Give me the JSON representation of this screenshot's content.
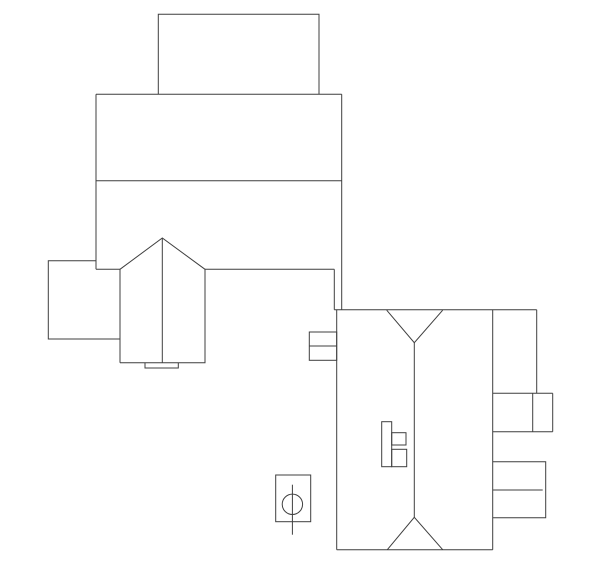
{
  "canvas": {
    "width": 600,
    "height": 569,
    "background_color": "#ffffff",
    "stroke_color": "#3f3f3f",
    "stroke_width": 1
  },
  "drawing": {
    "shapes": [
      {
        "name": "upper-annex-rect-outline",
        "type": "polyline",
        "points": "158.3,94.3 158.3,14.3 319,14.3 319,94.3"
      },
      {
        "name": "main-block-top-edge",
        "type": "line",
        "x1": 96,
        "y1": 94.3,
        "x2": 341.7,
        "y2": 94.3
      },
      {
        "name": "main-block-left-edge",
        "type": "line",
        "x1": 96,
        "y1": 94.3,
        "x2": 96,
        "y2": 269.3
      },
      {
        "name": "main-block-right-edge",
        "type": "line",
        "x1": 341.7,
        "y1": 94.3,
        "x2": 341.7,
        "y2": 309.7
      },
      {
        "name": "main-block-divider",
        "type": "line",
        "x1": 96,
        "y1": 180.7,
        "x2": 341.7,
        "y2": 180.7
      },
      {
        "name": "main-block-bottom-left-segment",
        "type": "line",
        "x1": 96,
        "y1": 269.3,
        "x2": 120,
        "y2": 269.3
      },
      {
        "name": "main-block-bottom-right-segment",
        "type": "line",
        "x1": 205,
        "y1": 269.3,
        "x2": 334.3,
        "y2": 269.3
      },
      {
        "name": "main-block-step-left-edge",
        "type": "line",
        "x1": 334.3,
        "y1": 269.3,
        "x2": 334.3,
        "y2": 309.7
      },
      {
        "name": "left-annex-outline",
        "type": "polyline",
        "points": "96,260.7 48.3,260.7 48.3,339 120,339"
      },
      {
        "name": "gable-wing-outline",
        "type": "polyline",
        "points": "120,362.7 120,269.3 162.3,238 205,269.3 205,362.7 120,362.7"
      },
      {
        "name": "gable-wing-ridge-line",
        "type": "line",
        "x1": 162.3,
        "y1": 238,
        "x2": 162.3,
        "y2": 362.7
      },
      {
        "name": "gable-wing-bottom-tab",
        "type": "polyline",
        "points": "145,362.7 145,368 178.3,368 178.3,362.7"
      },
      {
        "name": "lower-building-top-edge",
        "type": "line",
        "x1": 334.3,
        "y1": 309.7,
        "x2": 536.7,
        "y2": 309.7
      },
      {
        "name": "lower-building-left-edge",
        "type": "line",
        "x1": 336.7,
        "y1": 309.7,
        "x2": 336.7,
        "y2": 549.7
      },
      {
        "name": "lower-building-bottom-edge",
        "type": "line",
        "x1": 336.7,
        "y1": 549.7,
        "x2": 492.7,
        "y2": 549.7
      },
      {
        "name": "lower-building-right-edge",
        "type": "line",
        "x1": 492.7,
        "y1": 309.7,
        "x2": 492.7,
        "y2": 549.7
      },
      {
        "name": "lower-building-top-hip-valley",
        "type": "polyline",
        "points": "386.7,310.2 414.3,342.7 442.7,310.2"
      },
      {
        "name": "lower-building-ridge-line",
        "type": "line",
        "x1": 414.3,
        "y1": 342.7,
        "x2": 414.3,
        "y2": 517.3
      },
      {
        "name": "lower-building-bottom-hip-valley",
        "type": "polyline",
        "points": "387.3,549.7 414.3,517.3 442.7,549.7"
      },
      {
        "name": "left-window-bay-rect",
        "type": "rect",
        "x": 309.3,
        "y": 332,
        "w": 27.4,
        "h": 28.3
      },
      {
        "name": "left-window-bay-divider",
        "type": "line",
        "x1": 309.3,
        "y1": 346,
        "x2": 336.7,
        "y2": 346
      },
      {
        "name": "top-right-wing-right-edge",
        "type": "line",
        "x1": 536.7,
        "y1": 309.7,
        "x2": 536.7,
        "y2": 393.3
      },
      {
        "name": "right-wing-upper-shelf-top",
        "type": "line",
        "x1": 492.7,
        "y1": 393.3,
        "x2": 552.7,
        "y2": 393.3
      },
      {
        "name": "right-wing-upper-shelf-divider",
        "type": "line",
        "x1": 532.7,
        "y1": 393.3,
        "x2": 532.7,
        "y2": 431.7
      },
      {
        "name": "right-wing-upper-shelf-right",
        "type": "line",
        "x1": 552.7,
        "y1": 393.3,
        "x2": 552.7,
        "y2": 431.7
      },
      {
        "name": "right-wing-upper-shelf-bottom",
        "type": "line",
        "x1": 492.7,
        "y1": 431.7,
        "x2": 552.7,
        "y2": 431.7
      },
      {
        "name": "right-wing-lower-bay-outline",
        "type": "polyline",
        "points": "492.7,461.7 545.7,461.7 545.7,517.7 492.7,517.7"
      },
      {
        "name": "right-wing-lower-bay-divider",
        "type": "line",
        "x1": 492.7,
        "y1": 490,
        "x2": 542.7,
        "y2": 490
      },
      {
        "name": "interior-stair-bar",
        "type": "rect",
        "x": 381.7,
        "y": 421.7,
        "w": 10,
        "h": 45
      },
      {
        "name": "interior-stair-upper-step",
        "type": "rect",
        "x": 391.7,
        "y": 432.7,
        "w": 14.3,
        "h": 12.3
      },
      {
        "name": "interior-stair-lower-step",
        "type": "rect",
        "x": 391.7,
        "y": 449.3,
        "w": 15,
        "h": 17.4
      },
      {
        "name": "column-fixture-rect",
        "type": "rect",
        "x": 275.7,
        "y": 475,
        "w": 35,
        "h": 46.7
      },
      {
        "name": "column-fixture-circle",
        "type": "circle",
        "cx": 292.4,
        "cy": 504.3,
        "r": 10.2
      },
      {
        "name": "column-fixture-centerline",
        "type": "line",
        "x1": 292.4,
        "y1": 484.7,
        "x2": 292.4,
        "y2": 534.7
      }
    ]
  }
}
